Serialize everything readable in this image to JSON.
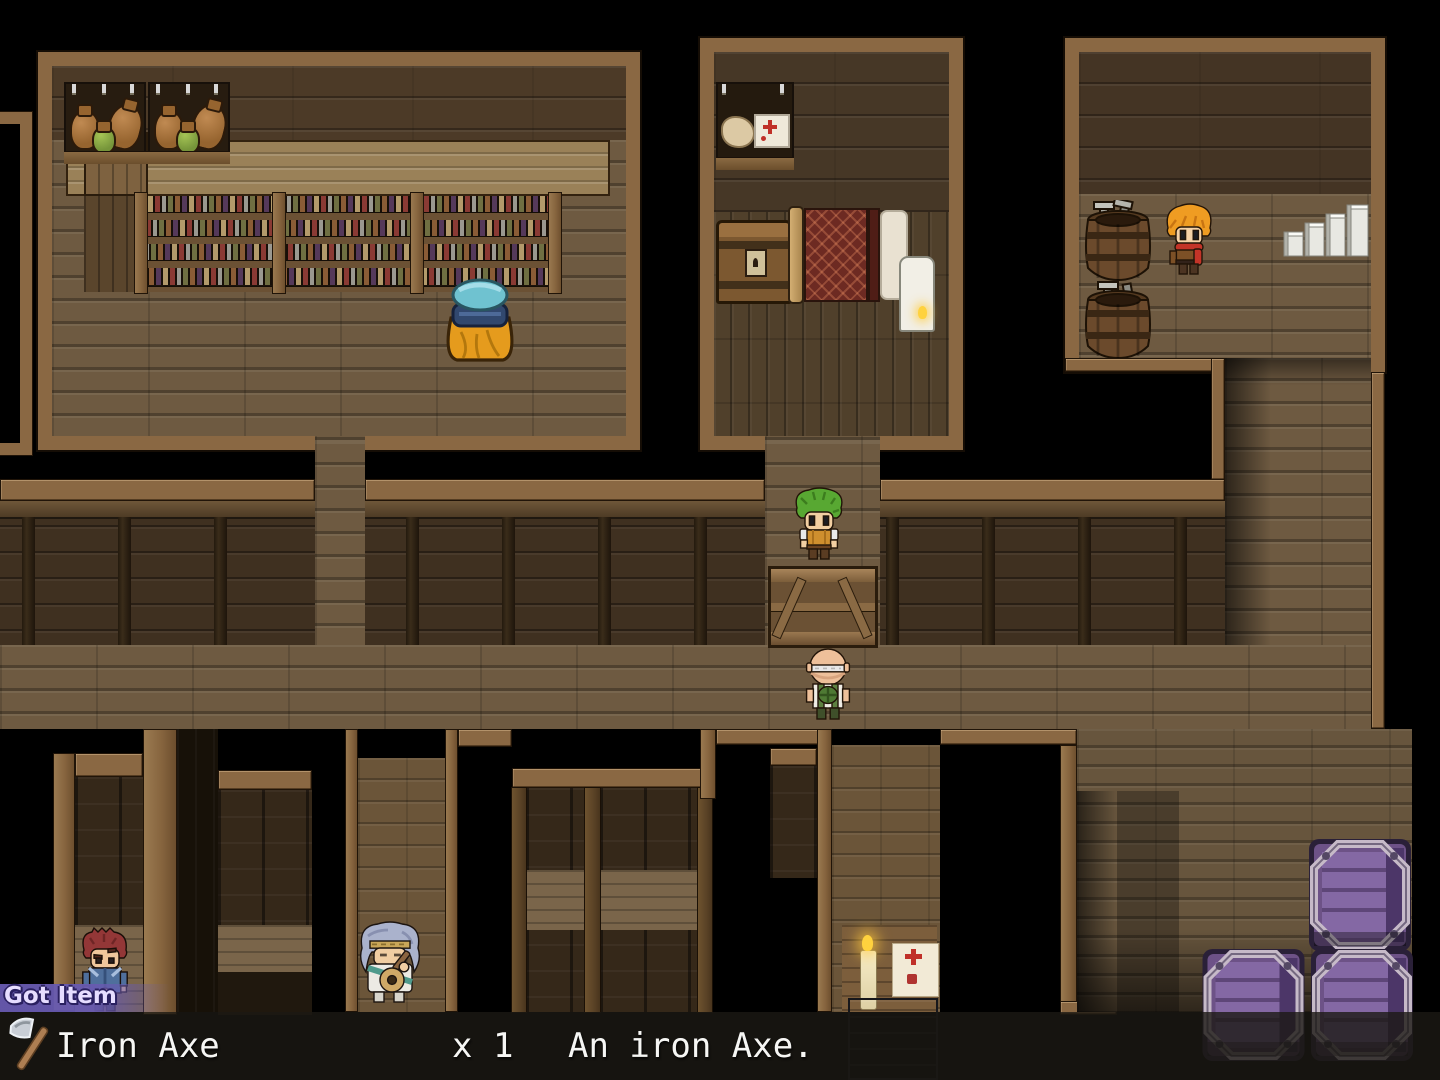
{
  "screen": {
    "width": 1440,
    "height": 1080,
    "type": "rpg-top-down-interior"
  },
  "hud": {
    "got_item_popup": {
      "label": "Got Item",
      "background_color": "#685ab0",
      "text_color": "#e6ddff"
    },
    "item_message_bar": {
      "icon": "axe-icon",
      "item_name": "Iron Axe",
      "quantity": "x 1",
      "description": "An iron Axe.",
      "background_color": "rgba(28,25,20,0.8)",
      "text_color": "#f6f6f4"
    }
  },
  "palette": {
    "frame_trim": "#8a6843",
    "room_wall": "#4c3a27",
    "corridor_wall": "#3f3020",
    "floor": "#6e5a41",
    "room_floor_dark": "#50402b",
    "counter": "#9a8158",
    "crate_purple": "#7a5c96",
    "crate_metal": "#c6bac8",
    "void": "#000000",
    "popup_purple": "#685ab0",
    "candle_flame": "#ffd23e"
  },
  "scene": {
    "rooms": [
      "shop-storage-room",
      "bedroom",
      "armory-room",
      "left-partial-room",
      "corridor",
      "right-hallway",
      "lower-rooms"
    ],
    "characters": [
      {
        "name": "green-haired-villager",
        "location": "middle-doorway"
      },
      {
        "name": "bald-craftsman",
        "location": "corridor"
      },
      {
        "name": "orange-haired-hero",
        "location": "armory-room"
      },
      {
        "name": "red-haired-man",
        "location": "lower-left-room"
      },
      {
        "name": "old-bard",
        "location": "lower-middle-doorway"
      }
    ],
    "objects": [
      "pot-shelf",
      "bottle-shelves",
      "counter",
      "supply-sack",
      "wall-shelf",
      "treasure-chest",
      "bed",
      "lamp",
      "tool-barrels",
      "white-stairs",
      "wooden-counter-crate",
      "purple-crates",
      "candle",
      "paper-notice",
      "stove"
    ]
  }
}
